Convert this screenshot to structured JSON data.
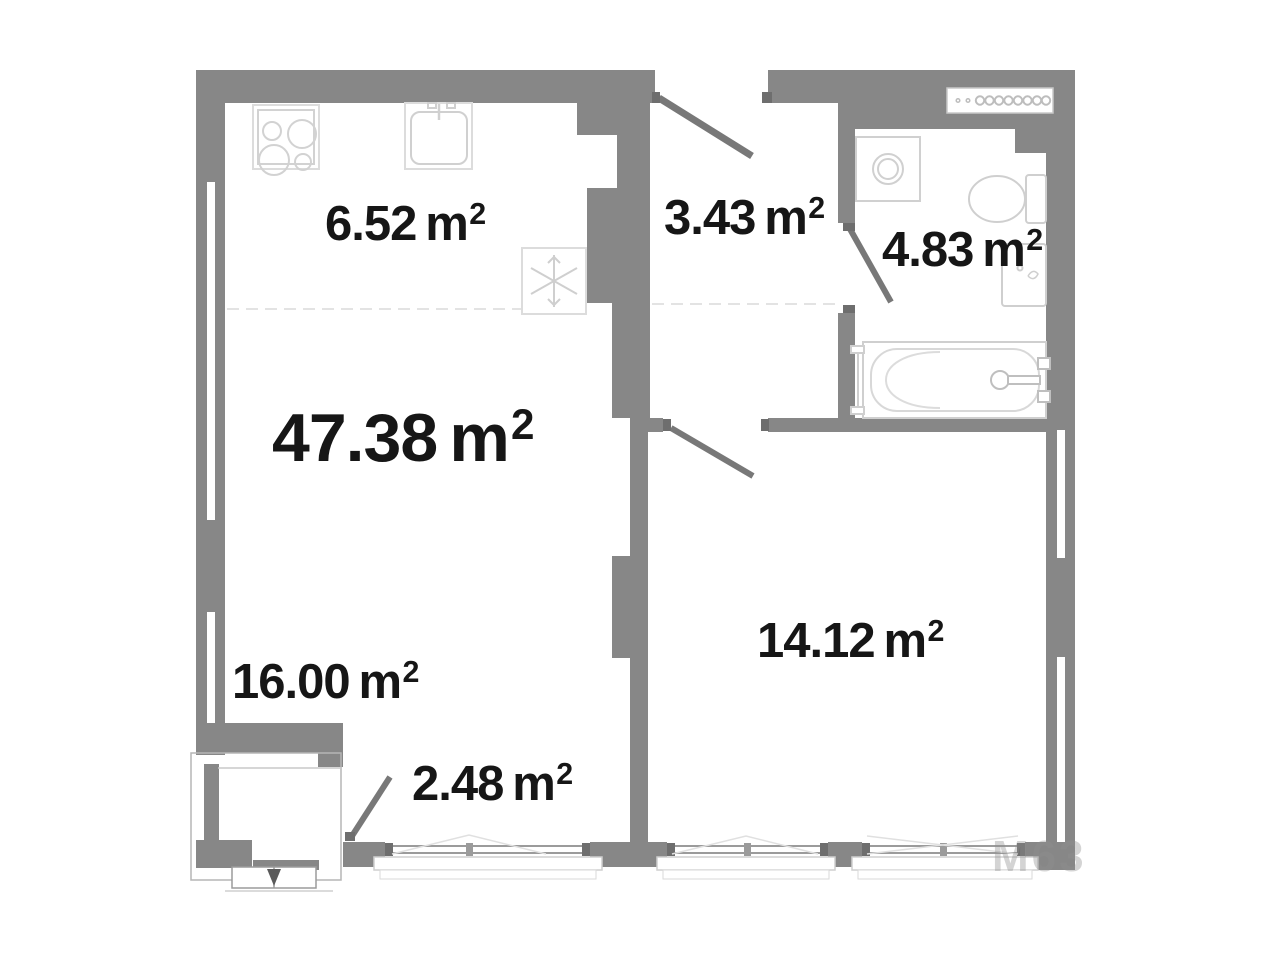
{
  "document": {
    "type": "apartment-floor-plan"
  },
  "units": {
    "base": "m",
    "sup": "2"
  },
  "areas": {
    "total": "47.38",
    "kitchen": "6.52",
    "hallway": "3.43",
    "bathroom": "4.83",
    "living_room": "16.00",
    "balcony": "2.48",
    "bedroom": "14.12"
  },
  "watermark": "М63",
  "colors": {
    "wall": "#878787",
    "fixture_stroke": "#cfcfcf",
    "door": "#787878",
    "text": "#161616",
    "background": "#ffffff"
  },
  "symbols": [
    "stove",
    "kitchen-sink",
    "fridge",
    "washing-machine",
    "toilet",
    "wash-basin",
    "bathtub",
    "towel-radiator",
    "ventilation-grille",
    "door-swing",
    "window"
  ]
}
